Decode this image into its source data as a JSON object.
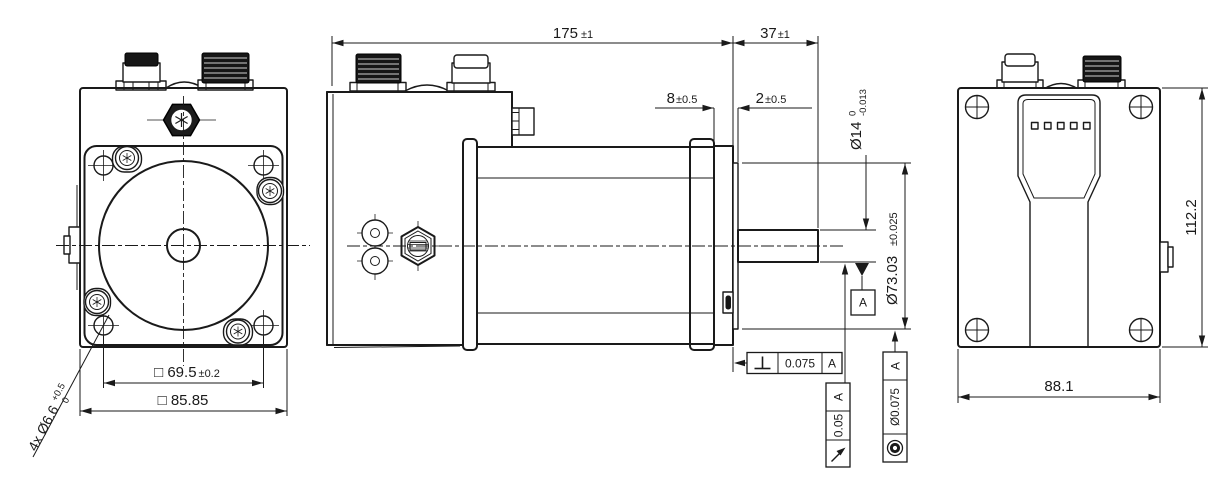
{
  "drawing": {
    "type": "mechanical-dimension-drawing",
    "colors": {
      "line": "#1a1a1a",
      "background": "#ffffff"
    },
    "dims": {
      "overall_length": {
        "main": "175",
        "tol": "±1"
      },
      "shaft_length": {
        "main": "37",
        "tol": "±1"
      },
      "flange_thickness": {
        "main": "8",
        "tol": "±0.5"
      },
      "pilot_height": {
        "main": "2",
        "tol": "±0.5"
      },
      "shaft_diameter": {
        "main": "Ø14",
        "tol_upper": "0",
        "tol_lower": "-0.013"
      },
      "pilot_diameter": {
        "main": "Ø73.03",
        "tol": "±0.025"
      },
      "body_height": {
        "main": "112.2"
      },
      "body_width": {
        "main": "88.1"
      },
      "bolt_square": {
        "main": "□ 69.5",
        "tol": "±0.2"
      },
      "flange_square": {
        "main": "□ 85.85"
      },
      "mounting_holes": {
        "main": "4x Ø6.6",
        "tol_upper": "+0.5",
        "tol_lower": "0"
      }
    },
    "gdt": {
      "datum": {
        "label": "A"
      },
      "perpendicularity": {
        "value": "0.075",
        "datum": "A"
      },
      "runout": {
        "value": "0.05",
        "datum": "A"
      },
      "concentricity": {
        "value": "Ø0.075",
        "datum": "A"
      }
    }
  }
}
